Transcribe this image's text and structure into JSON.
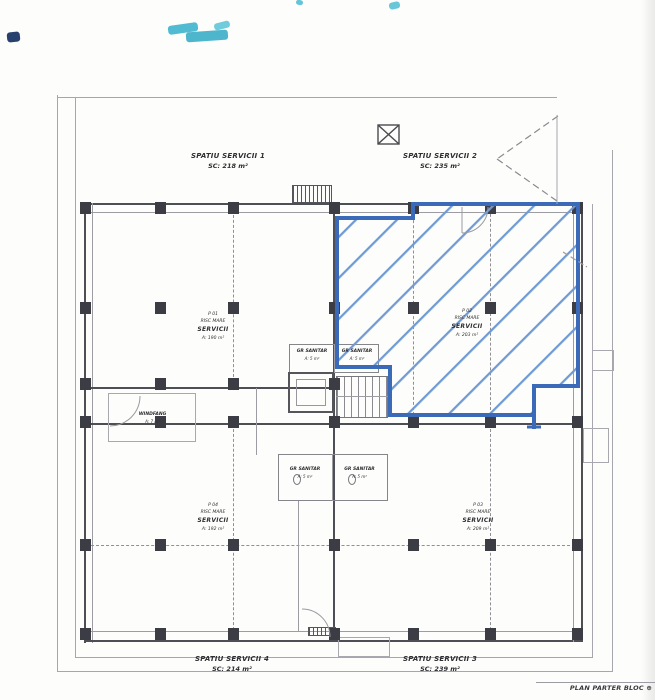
{
  "header_labels": {
    "spatiu1": {
      "name": "SPATIU SERVICII 1",
      "area": "SC: 218 m²"
    },
    "spatiu2": {
      "name": "SPATIU SERVICII 2",
      "area": "SC: 235 m²"
    }
  },
  "footer_labels": {
    "spatiu4": {
      "name": "SPATIU SERVICII 4",
      "area": "SC: 214 m²"
    },
    "spatiu3": {
      "name": "SPATIU SERVICII 3",
      "area": "SC: 239 m²"
    }
  },
  "rooms": {
    "p01": {
      "code": "P 01",
      "risc": "RISC MARE",
      "func": "SERVICII",
      "area": "A: 190 m²"
    },
    "p02": {
      "code": "P 02",
      "risc": "RISC MARE",
      "func": "SERVICII",
      "area": "A: 203 m²"
    },
    "p03": {
      "code": "P 03",
      "risc": "RISC MARE",
      "func": "SERVICII",
      "area": "A: 209 m²"
    },
    "p04": {
      "code": "P 04",
      "risc": "RISC MARE",
      "func": "SERVICII",
      "area": "A: 192 m²"
    }
  },
  "core": {
    "windfang": {
      "name": "WINDFANG",
      "area": "A: 7 m²"
    },
    "sanitar_up_left": {
      "name": "GR SANITAR",
      "area": "A: 5 m²"
    },
    "sanitar_up_right": {
      "name": "GR SANITAR",
      "area": "A: 5 m²"
    },
    "sanitar_low_left": {
      "name": "GR SANITAR",
      "area": "A: 5 m²"
    },
    "sanitar_low_right": {
      "name": "GR SANITAR",
      "area": "A: 5 m²"
    }
  },
  "titleblock": {
    "text": "PLAN PARTER BLOC",
    "symbol": "⊕"
  },
  "palette": {
    "hatch_blue": "#6f9bd4",
    "outline_blue": "#3b6ab8",
    "wall": "#4e4e55",
    "pier": "#3c3c45",
    "cyan_mark": "#3db4cc",
    "navy_mark": "#27406e"
  },
  "drawing": {
    "piers": [
      [
        85,
        208
      ],
      [
        160,
        208
      ],
      [
        233,
        208
      ],
      [
        334,
        208
      ],
      [
        413,
        208
      ],
      [
        490,
        208
      ],
      [
        577,
        208
      ],
      [
        85,
        308
      ],
      [
        160,
        308
      ],
      [
        233,
        308
      ],
      [
        334,
        308
      ],
      [
        413,
        308
      ],
      [
        490,
        308
      ],
      [
        577,
        308
      ],
      [
        85,
        384
      ],
      [
        160,
        384
      ],
      [
        233,
        384
      ],
      [
        334,
        384
      ],
      [
        85,
        422
      ],
      [
        160,
        422
      ],
      [
        233,
        422
      ],
      [
        334,
        422
      ],
      [
        413,
        422
      ],
      [
        490,
        422
      ],
      [
        577,
        422
      ],
      [
        85,
        545
      ],
      [
        160,
        545
      ],
      [
        233,
        545
      ],
      [
        334,
        545
      ],
      [
        413,
        545
      ],
      [
        490,
        545
      ],
      [
        577,
        545
      ],
      [
        85,
        634
      ],
      [
        160,
        634
      ],
      [
        233,
        634
      ],
      [
        334,
        634
      ],
      [
        413,
        634
      ],
      [
        490,
        634
      ],
      [
        577,
        634
      ]
    ]
  }
}
